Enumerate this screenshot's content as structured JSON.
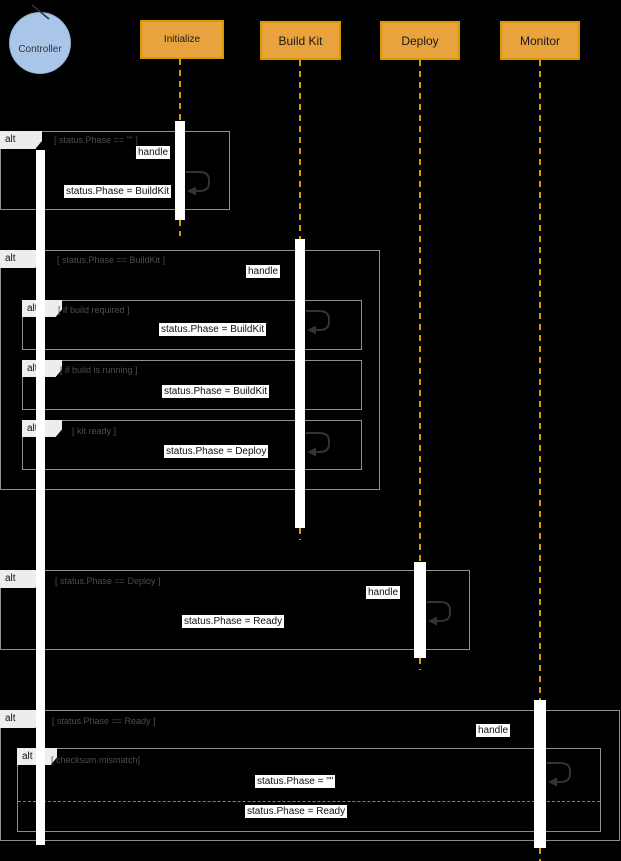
{
  "colors": {
    "background": "#000000",
    "header_fill": "#E8A33D",
    "header_border": "#D79B00",
    "header_text": "#1A1A1A",
    "lifeline": "#D79B00",
    "frame_border": "#8F8F8F",
    "operator_fill": "#EDEDED",
    "operator_text": "#111111",
    "condition_text": "#4D4D4D",
    "message_bg": "#FFFFFF",
    "message_text": "#111111",
    "activation_fill": "#FFFFFF",
    "loop_arrow": "#333333",
    "controller_fill": "#A9C6E8"
  },
  "actors": {
    "controller": {
      "label": "Controller",
      "type": "control"
    },
    "initialize": {
      "label": "Initialize"
    },
    "buildkit": {
      "label": "Build Kit"
    },
    "deploy": {
      "label": "Deploy"
    },
    "monitor": {
      "label": "Monitor"
    }
  },
  "fragments": {
    "alt1": {
      "operator": "alt",
      "condition": "[ status.Phase == \"\" ]"
    },
    "alt2": {
      "operator": "alt",
      "condition": "[ status.Phase == BuildKit ]"
    },
    "alt2a": {
      "operator": "alt",
      "condition": "[ if build required ]"
    },
    "alt2b": {
      "operator": "alt",
      "condition": "[ if build is running ]"
    },
    "alt2c": {
      "operator": "alt",
      "condition": "[ kit ready ]"
    },
    "alt3": {
      "operator": "alt",
      "condition": "[ status.Phase == Deploy ]"
    },
    "alt4": {
      "operator": "alt",
      "condition": "[ status.Phase == Ready ]"
    },
    "alt5": {
      "operator": "alt",
      "condition": "[ checksum mismatch]"
    }
  },
  "messages": {
    "handle_initialize": "handle",
    "return_buildkit": "status.Phase = BuildKit",
    "handle_buildkit": "handle",
    "set_phase_buildkit_required": "status.Phase = BuildKit",
    "set_phase_buildkit_running": "status.Phase = BuildKit",
    "set_phase_deploy": "status.Phase = Deploy",
    "handle_deploy": "handle",
    "set_phase_ready": "status.Phase = Ready",
    "handle_monitor": "handle",
    "set_phase_empty": "status.Phase = \"\"",
    "set_phase_ready_final": "status.Phase = Ready"
  }
}
